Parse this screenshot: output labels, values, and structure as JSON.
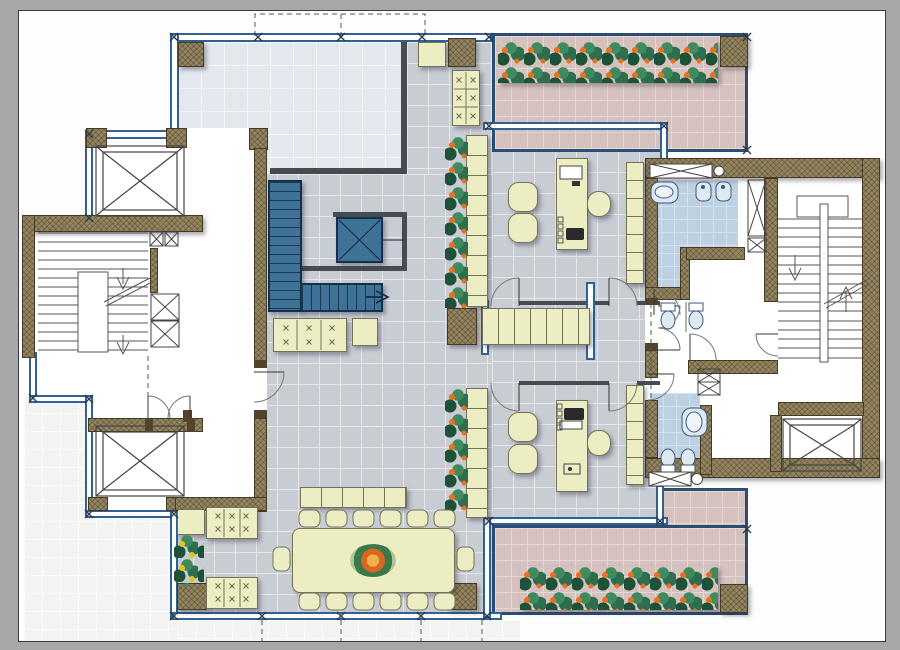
{
  "scene": {
    "kind": "architectural-floor-plan",
    "style": "colored CAD presentation drawing, no text labels visible"
  },
  "colors": {
    "canvas": "#a8a8a8",
    "pageBg": "#fdfdfd",
    "wallBrown": "#95855f",
    "wallBrownDark": "#53432c",
    "wallBlue": "#2f6195",
    "navy": "#2b4d72",
    "darkWall": "#474c52",
    "stairBlue": "#3e7296",
    "stairBlueDark": "#14304c",
    "cream": "#ededc3",
    "creamBorder": "#73735a",
    "tileLobby": "#c8ccd3",
    "tileLobbyLine": "#e4e6ea",
    "tileHall": "#e3e7ee",
    "tileHallLine": "#f3f5f8",
    "tilePink": "#d5c2bf",
    "tilePinkLine": "#e5d7d4",
    "tileBlue": "#bdd1e3",
    "tileBlueLine": "#d4e2ef",
    "tileWhite": "#f3f3f1",
    "tileWhiteLine": "#fbfbf9",
    "foliageDark": "#1e5238",
    "foliageMid": "#2c6e4e",
    "foliageLight": "#3f8a5e",
    "flowerOrange": "#e8701f",
    "flowerYellow": "#e2c41e",
    "fixtureFill": "#dfe9f2",
    "fixtureStroke": "#3a5a7a",
    "lineGray": "#555555"
  },
  "inventory": {
    "elevator_shafts": 4,
    "enclosed_stairwells": 2,
    "open_feature_stair": 1,
    "offices_with_desks": 2,
    "bathrooms": 2,
    "flower_terraces": 2,
    "white_terrace": 1,
    "conference_table_seats": 14,
    "sofas": 4,
    "armchairs": 4,
    "planter_strips": 5
  }
}
